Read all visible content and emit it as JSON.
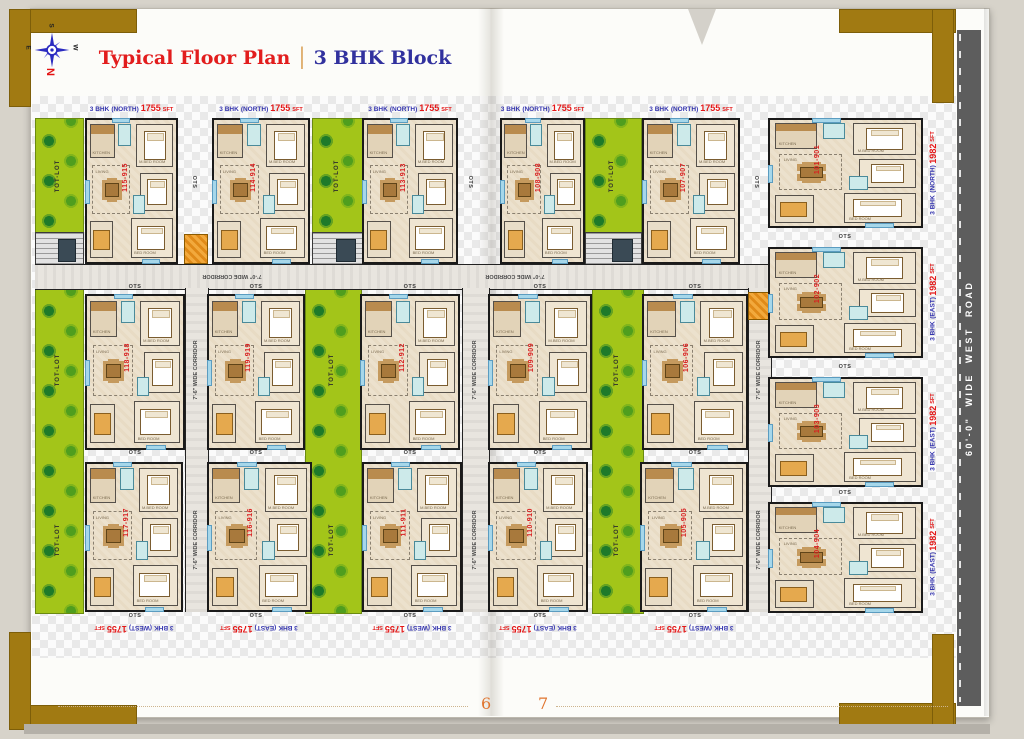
{
  "header": {
    "title_red": "Typical Floor Plan",
    "separator": "|",
    "title_blue": "3 BHK Block"
  },
  "compass": {
    "n": "N",
    "s": "S",
    "e": "E",
    "w": "W"
  },
  "road_label": "60'-0\"  WIDE  WEST  ROAD",
  "page_numbers": {
    "left": "6",
    "right": "7"
  },
  "plan_labels": {
    "tot_lot": "TOT-LOT",
    "ots": "OTS",
    "corridor_h": "7'-0\" WIDE CORRIDOR",
    "corridor_v": "7'-6\" WIDE CORRIDOR"
  },
  "room_names": [
    "KITCHEN",
    "DINING",
    "LIVING",
    "M.BED ROOM",
    "BED ROOM",
    "TOILET"
  ],
  "unit_numbers": {
    "top": [
      "115-915",
      "114-914",
      "113-913",
      "108-908",
      "107-907"
    ],
    "row2": [
      "118-918",
      "119-919",
      "112-912",
      "109-909",
      "106-906"
    ],
    "row3": [
      "117-917",
      "116-916",
      "111-911",
      "110-910",
      "105-905"
    ],
    "right": [
      "101-901",
      "102-902",
      "103-903",
      "104-904"
    ]
  },
  "top_labels": [
    {
      "bhk": "3 BHK",
      "facing": "(NORTH)",
      "area": "1755",
      "sft": "SFT"
    },
    {
      "bhk": "3 BHK",
      "facing": "(NORTH)",
      "area": "1755",
      "sft": "SFT"
    },
    {
      "bhk": "3 BHK",
      "facing": "(NORTH)",
      "area": "1755",
      "sft": "SFT"
    },
    {
      "bhk": "3 BHK",
      "facing": "(NORTH)",
      "area": "1755",
      "sft": "SFT"
    },
    {
      "bhk": "3 BHK",
      "facing": "(NORTH)",
      "area": "1755",
      "sft": "SFT"
    }
  ],
  "bottom_labels": [
    {
      "bhk": "3 BHK",
      "facing": "(WEST)",
      "area": "1755",
      "sft": "SFT"
    },
    {
      "bhk": "3 BHK",
      "facing": "(EAST)",
      "area": "1755",
      "sft": "SFT"
    },
    {
      "bhk": "3 BHK",
      "facing": "(WEST)",
      "area": "1755",
      "sft": "SFT"
    },
    {
      "bhk": "3 BHK",
      "facing": "(EAST)",
      "area": "1755",
      "sft": "SFT"
    },
    {
      "bhk": "3 BHK",
      "facing": "(WEST)",
      "area": "1755",
      "sft": "SFT"
    }
  ],
  "right_labels": [
    {
      "bhk": "3 BHK",
      "facing": "(NORTH)",
      "area": "1982",
      "sft": "SFT"
    },
    {
      "bhk": "3 BHK",
      "facing": "(EAST)",
      "area": "1982",
      "sft": "SFT"
    },
    {
      "bhk": "3 BHK",
      "facing": "(EAST)",
      "area": "1982",
      "sft": "SFT"
    },
    {
      "bhk": "3 BHK",
      "facing": "(EAST)",
      "area": "1982",
      "sft": "SFT"
    }
  ]
}
